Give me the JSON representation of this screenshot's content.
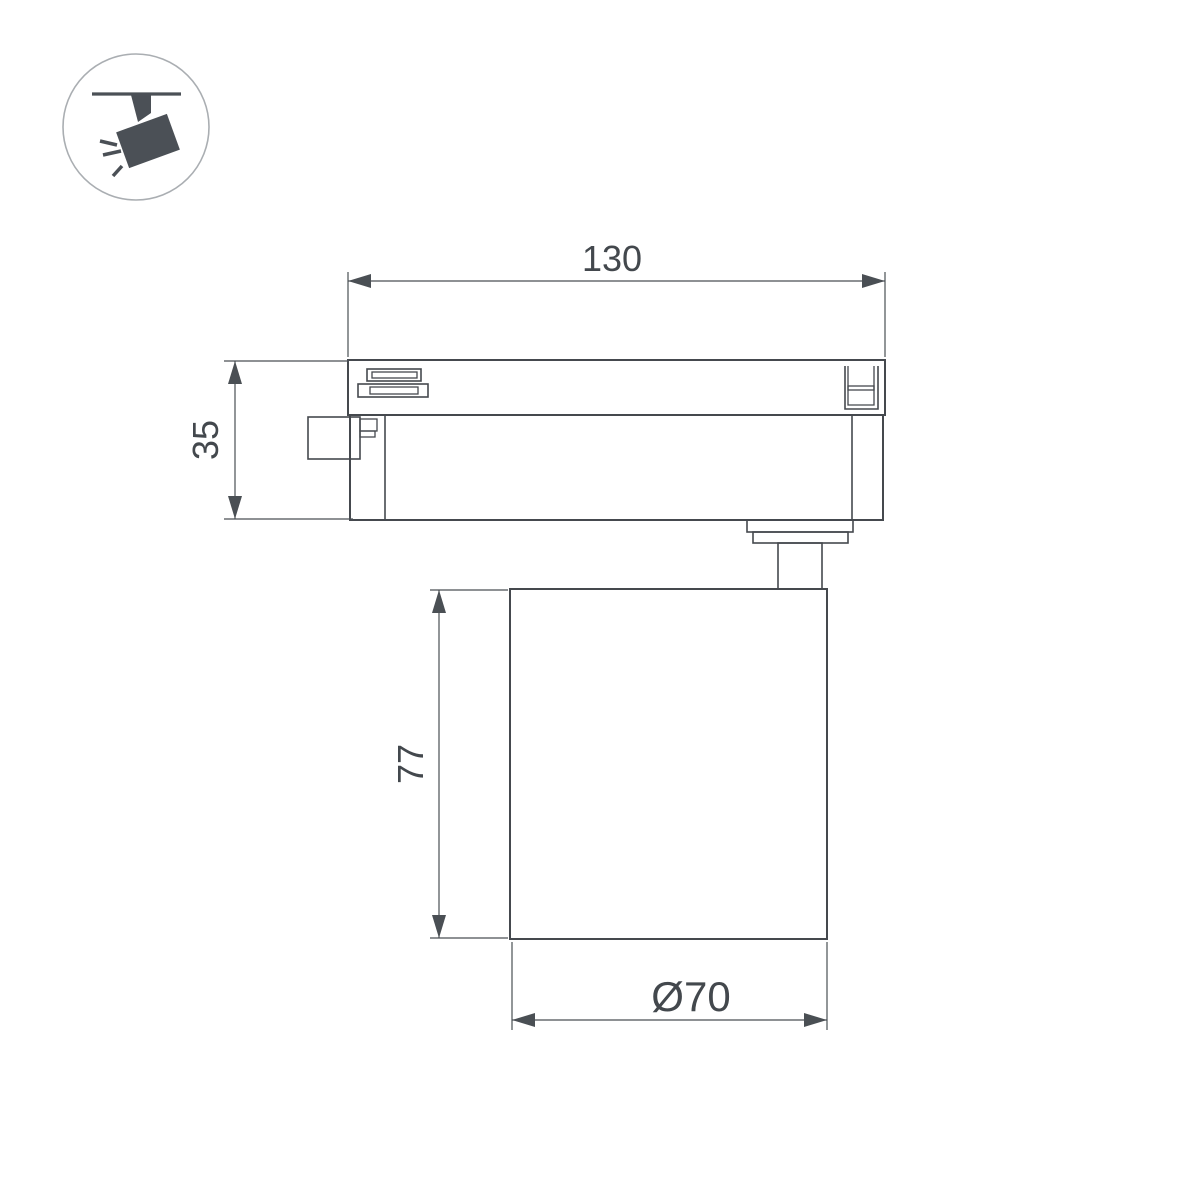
{
  "colors": {
    "background": "#ffffff",
    "line": "#45494e",
    "dim": "#4a4f54",
    "dim-text": "#43484d",
    "icon": "#4b5056",
    "icon-circle": "#aaaeb2"
  },
  "icon": {
    "name": "track-spotlight-icon"
  },
  "dimensions": {
    "width": "130",
    "adapter_height": "35",
    "lamp_height": "77",
    "lamp_diameter": "Ø70"
  }
}
